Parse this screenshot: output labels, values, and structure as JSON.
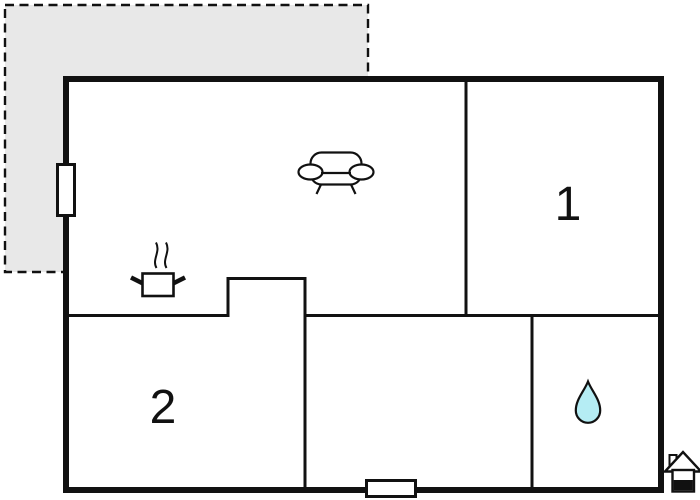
{
  "colors": {
    "background": "#ffffff",
    "terrace_fill": "#e8e8e8",
    "wall": "#111111",
    "water_drop_fill": "#b5edf4"
  },
  "rooms": [
    {
      "label": "1"
    },
    {
      "label": "2"
    }
  ],
  "icons": {
    "sofa": "sofa-icon",
    "cooking_pot": "cooking-pot-icon",
    "steam": "steam-icon",
    "water_drop": "water-drop-icon",
    "house_logo": "house-icon",
    "window": "window-marker",
    "door": "door-marker"
  }
}
